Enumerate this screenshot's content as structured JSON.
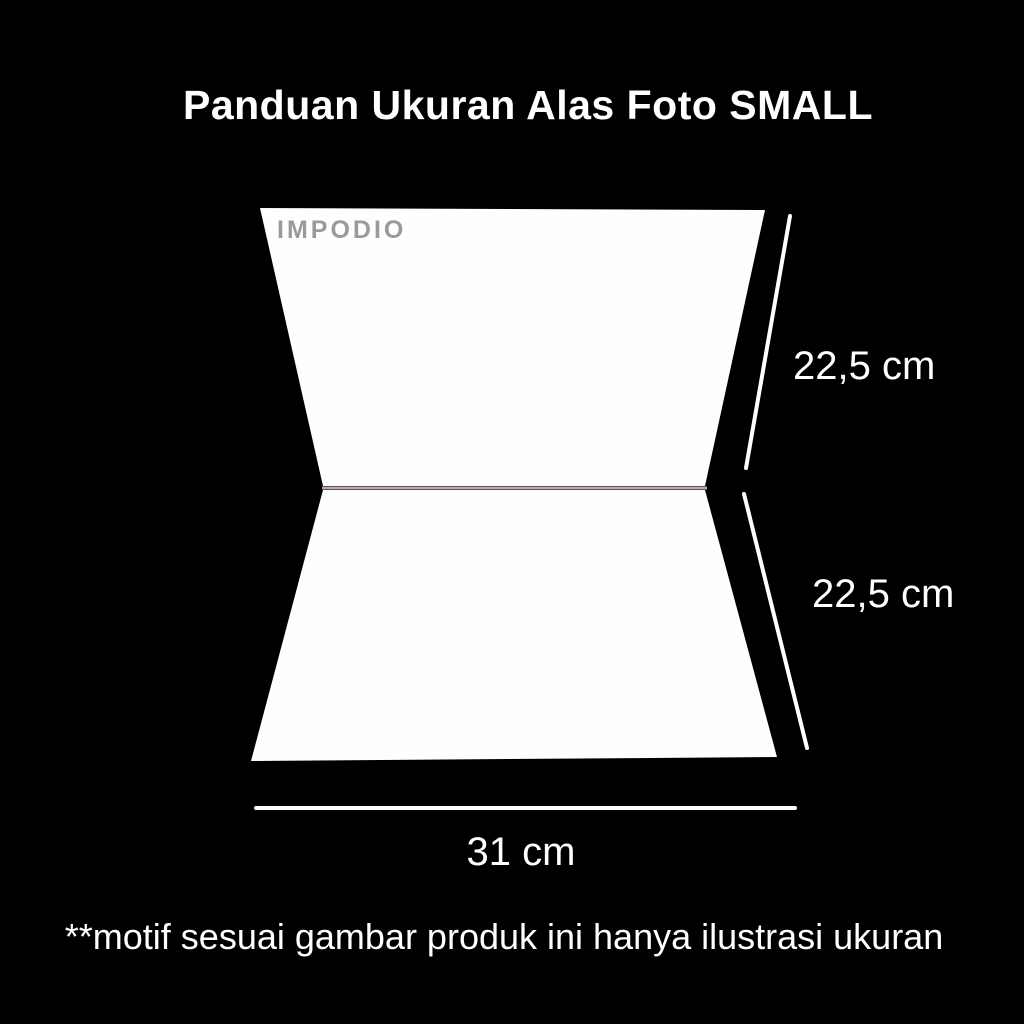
{
  "title": "Panduan Ukuran Alas Foto SMALL",
  "watermark": "IMPODIO",
  "measurements": {
    "top_panel_height": "22,5 cm",
    "bottom_panel_height": "22,5 cm",
    "width": "31 cm"
  },
  "disclaimer": "**motif sesuai gambar produk ini hanya ilustrasi ukuran",
  "colors": {
    "background": "#000000",
    "panel": "#fefefe",
    "fold_line": "#b8aca7",
    "measure_line": "#ffffff",
    "watermark": "#9a9a9a",
    "text": "#ffffff"
  }
}
